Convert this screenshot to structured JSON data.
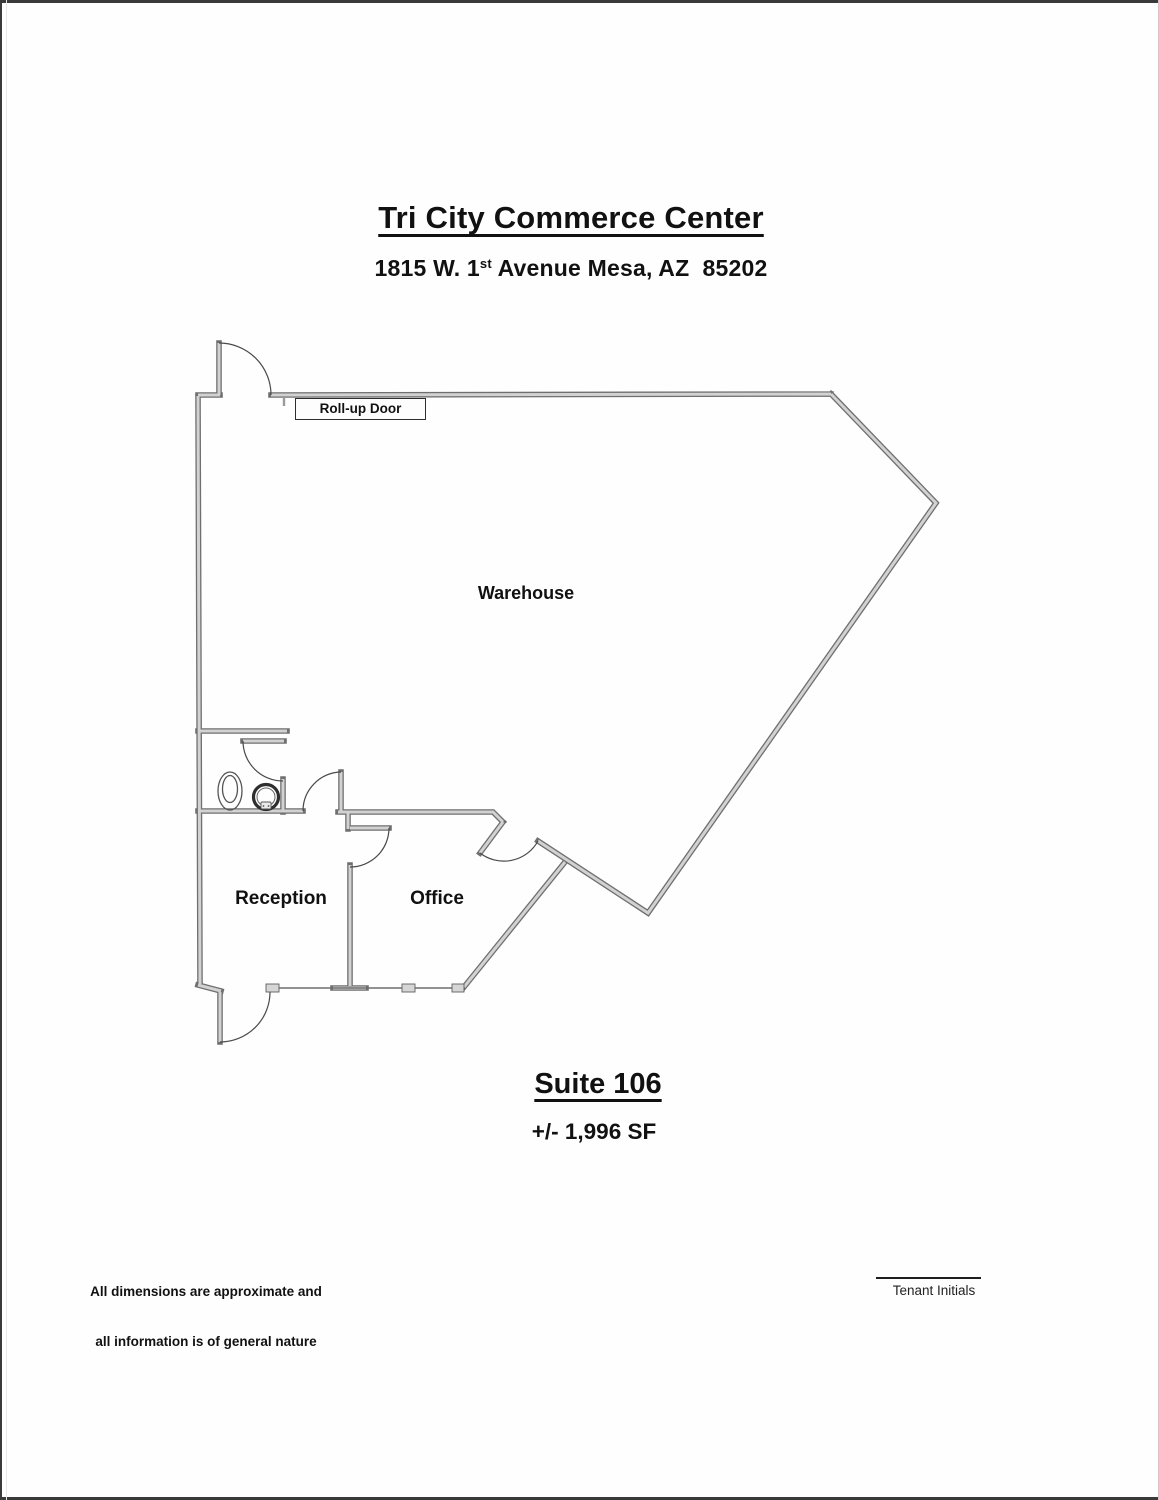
{
  "page": {
    "title": "Tri City Commerce Center",
    "address_pre": "1815 W. 1",
    "address_sup": "st",
    "address_post": " Avenue Mesa, AZ  85202",
    "suite_title": "Suite 106",
    "suite_area": "+/- 1,996 SF",
    "disclaimer_line1": "All dimensions are approximate and",
    "disclaimer_line2": "all information is of general nature",
    "tenant_initials_label": "Tenant Initials"
  },
  "floorplan": {
    "labels": {
      "rollup_door": "Roll-up Door",
      "warehouse": "Warehouse",
      "reception": "Reception",
      "office": "Office"
    },
    "fixtures": [
      "toilet",
      "sink"
    ],
    "colors": {
      "wall_outline": "#707070",
      "wall_fill": "#cfcfcf",
      "door_arc": "#4a4a4a",
      "page_edge": "#3a3a3a",
      "text": "#111111"
    }
  }
}
